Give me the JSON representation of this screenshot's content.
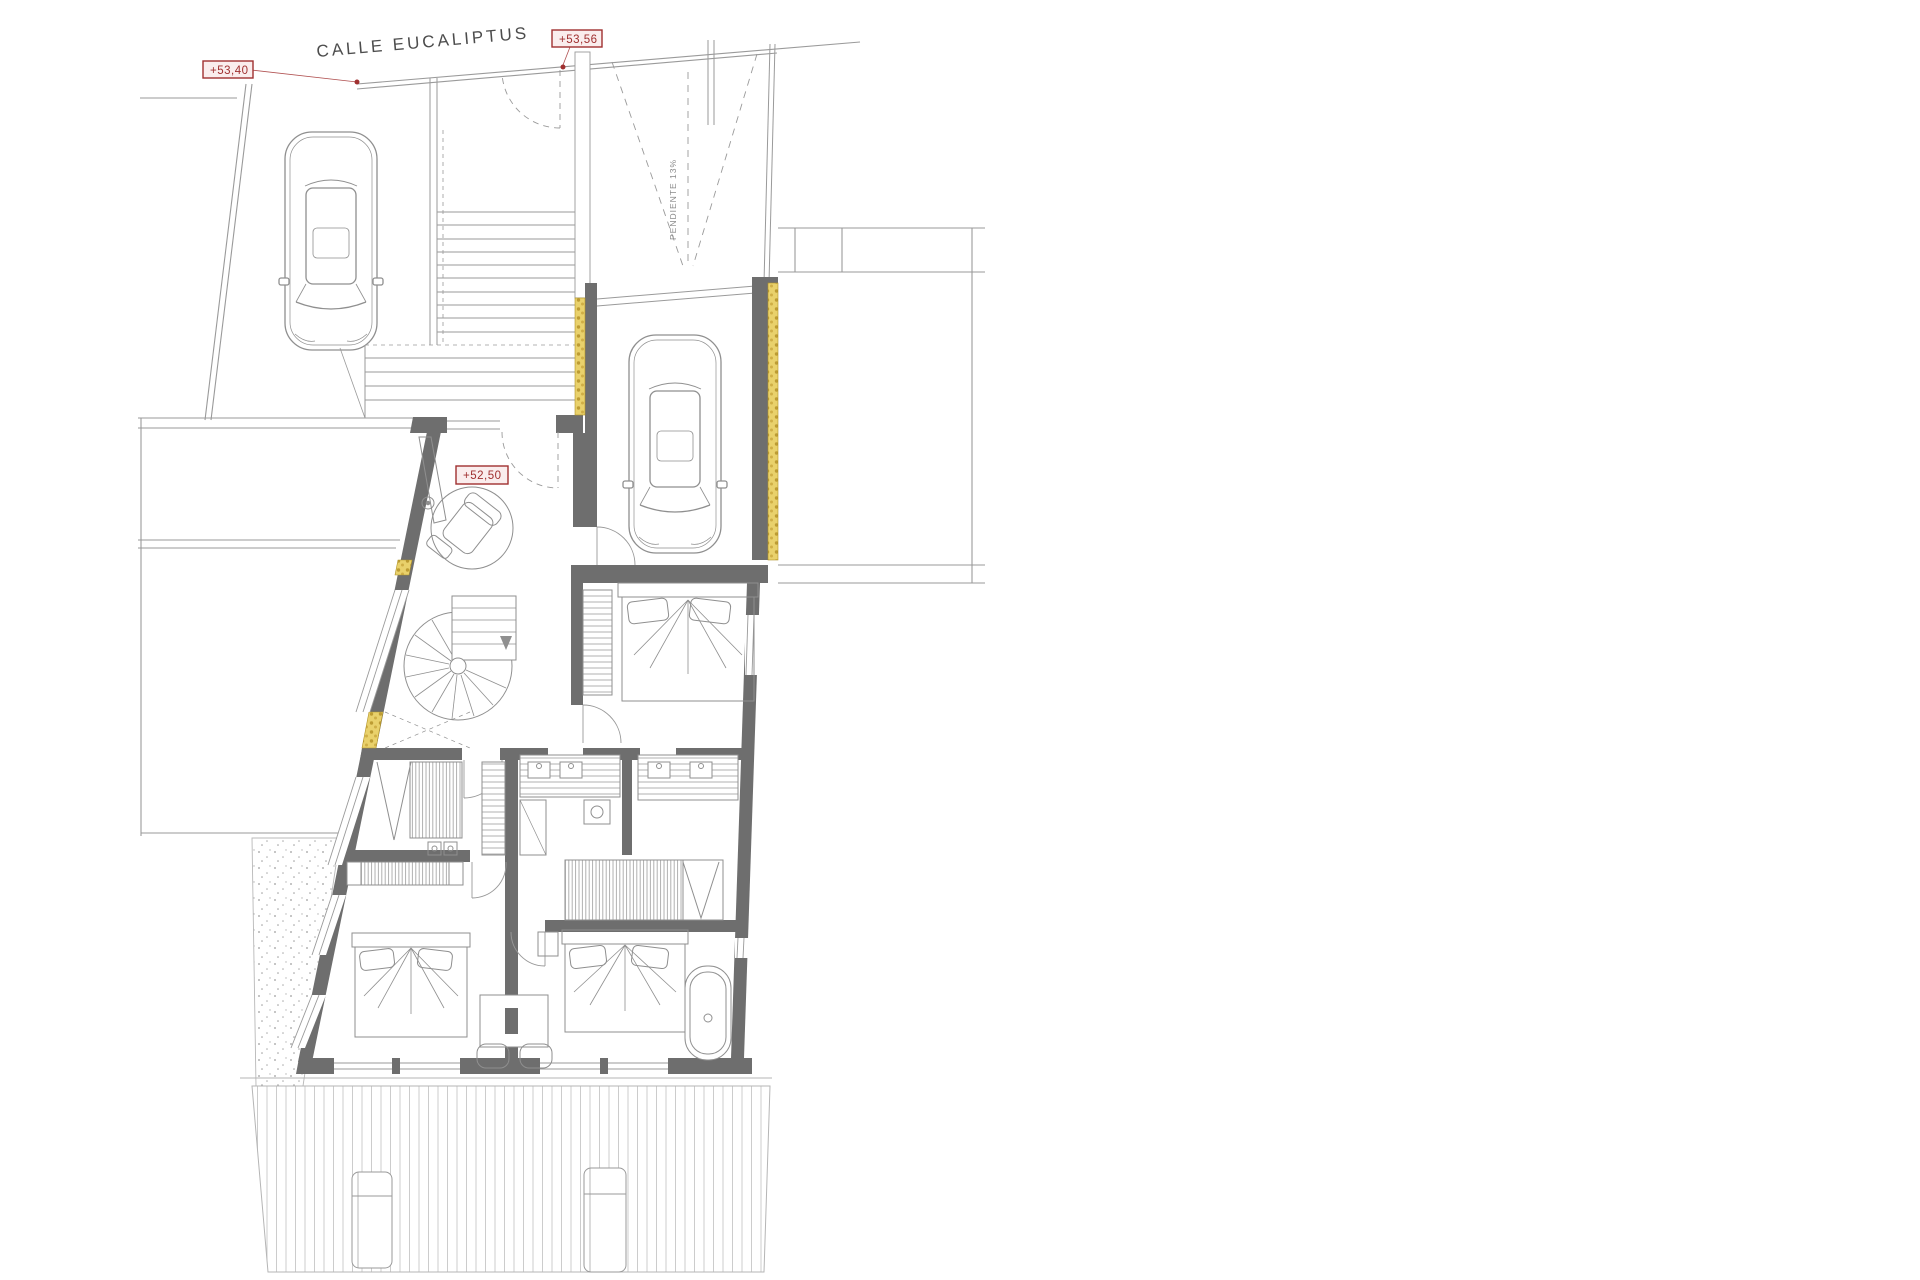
{
  "drawing": {
    "type": "architectural floor plan",
    "street_label": "CALLE EUCALIPTUS",
    "elevation_markers": {
      "street_west": "+53,40",
      "street_entrance": "+53,56",
      "entry_hall": "+52,50"
    },
    "ramp_slope_label": "PENDIENTE 13%"
  },
  "colors": {
    "background": "#ffffff",
    "wall_fill": "#6e6e6e",
    "thin_line": "#9a9a9a",
    "furniture_line": "#8f8f8f",
    "insulation_yellow": "#e9d16b",
    "insulation_dot": "#bd9c33",
    "label_red": "#a03030",
    "label_bg": "#faeded",
    "deck_line": "#c0c0c0"
  }
}
